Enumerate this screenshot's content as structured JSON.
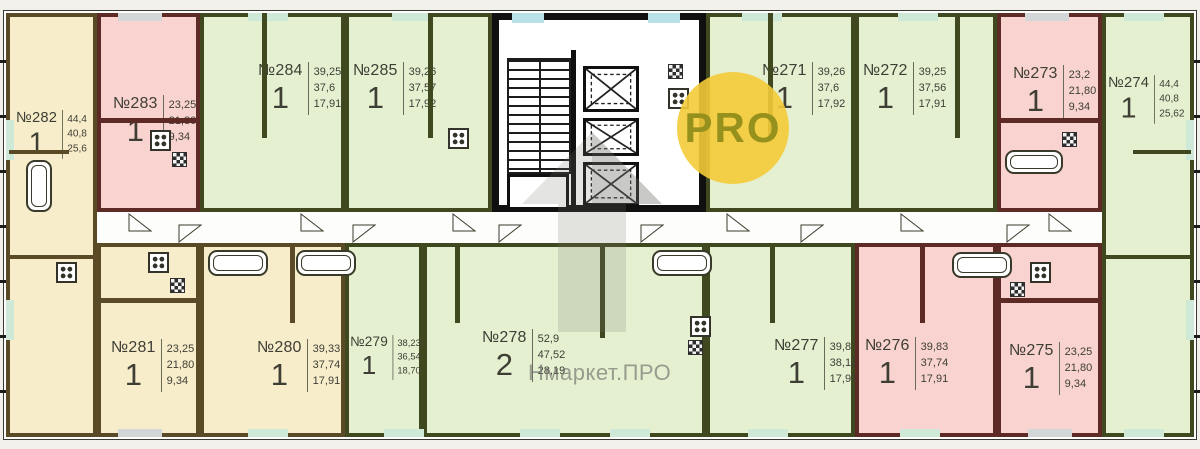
{
  "plan": {
    "watermark": {
      "text": "Нмаркет.ПРО"
    },
    "logo": {
      "text": "PRO"
    },
    "colors": {
      "unit_yellow": "#f7edca",
      "unit_pink": "#f8d3cf",
      "unit_green": "#e4f0d0",
      "wall_yellow": "#5a4a26",
      "wall_pink": "#5e2a25",
      "wall_green": "#40481f",
      "core_wall": "#101010",
      "sill_cyan": "#b9e2e8",
      "sill_green": "#cfe9d8"
    },
    "apartments": [
      {
        "id": "282",
        "number": "№282",
        "rooms": "1",
        "areas": [
          "44,4",
          "40,8",
          "25,6"
        ],
        "type": "yellow"
      },
      {
        "id": "283",
        "number": "№283",
        "rooms": "1",
        "areas": [
          "23,25",
          "21,80",
          "9,34"
        ],
        "type": "pink"
      },
      {
        "id": "284",
        "number": "№284",
        "rooms": "1",
        "areas": [
          "39,25",
          "37,6",
          "17,91"
        ],
        "type": "green"
      },
      {
        "id": "285",
        "number": "№285",
        "rooms": "1",
        "areas": [
          "39,26",
          "37,57",
          "17,92"
        ],
        "type": "green"
      },
      {
        "id": "271",
        "number": "№271",
        "rooms": "1",
        "areas": [
          "39,26",
          "37,6",
          "17,92"
        ],
        "type": "green"
      },
      {
        "id": "272",
        "number": "№272",
        "rooms": "1",
        "areas": [
          "39,25",
          "37,56",
          "17,91"
        ],
        "type": "green"
      },
      {
        "id": "273",
        "number": "№273",
        "rooms": "1",
        "areas": [
          "23,2",
          "21,80",
          "9,34"
        ],
        "type": "pink"
      },
      {
        "id": "274",
        "number": "№274",
        "rooms": "1",
        "areas": [
          "44,4",
          "40,8",
          "25,62"
        ],
        "type": "green"
      },
      {
        "id": "281",
        "number": "№281",
        "rooms": "1",
        "areas": [
          "23,25",
          "21,80",
          "9,34"
        ],
        "type": "yellow"
      },
      {
        "id": "280",
        "number": "№280",
        "rooms": "1",
        "areas": [
          "39,33",
          "37,74",
          "17,91"
        ],
        "type": "yellow"
      },
      {
        "id": "279",
        "number": "№279",
        "rooms": "1",
        "areas": [
          "38,23",
          "36,54",
          "18,70"
        ],
        "type": "green"
      },
      {
        "id": "278",
        "number": "№278",
        "rooms": "2",
        "areas": [
          "52,9",
          "47,52",
          "28,19"
        ],
        "type": "green"
      },
      {
        "id": "277",
        "number": "№277",
        "rooms": "1",
        "areas": [
          "39,8",
          "38,12",
          "17,97"
        ],
        "type": "green"
      },
      {
        "id": "276",
        "number": "№276",
        "rooms": "1",
        "areas": [
          "39,83",
          "37,74",
          "17,91"
        ],
        "type": "pink"
      },
      {
        "id": "275",
        "number": "№275",
        "rooms": "1",
        "areas": [
          "23,25",
          "21,80",
          "9,34"
        ],
        "type": "pink"
      }
    ]
  }
}
